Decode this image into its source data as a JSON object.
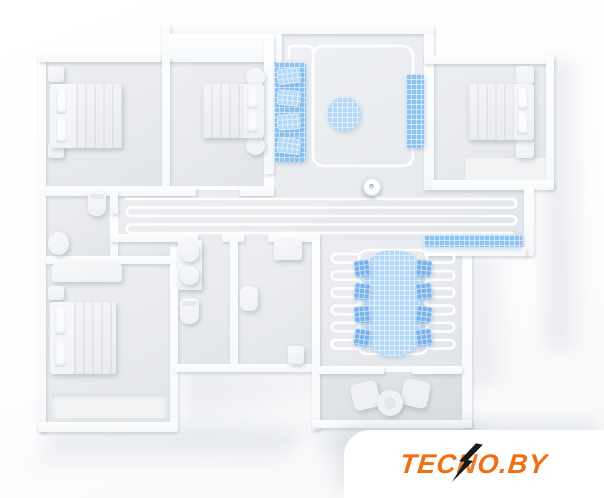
{
  "watermark": {
    "brand_pre": "TEC",
    "brand_bolt_letter": "N",
    "brand_post": "O.BY",
    "brand_full": "TECNO.BY",
    "text_color": "#ef6f12",
    "bolt_color": "#1a1a1a",
    "card_color": "#ffffff"
  },
  "palette": {
    "background": "#ffffff",
    "floor": "#e8eaed",
    "floor_balcony": "#dfe2e6",
    "wall": "#fcfdfe",
    "clean_path": "#ffffff",
    "highlight_blue": "#8ec4f2",
    "rug_blue": "#b3d8f8",
    "furniture_blue": "#77b2ec",
    "shadow": "#c6cdd5"
  },
  "scene": {
    "description": "3D top-down floor plan of an apartment; a robot vacuum's white cleaning paths snake through the rooms and cleaned carpets/furniture zones are highlighted in blue",
    "rooms": [
      "bedroom-top-left",
      "bedroom-top-middle",
      "living-room",
      "bedroom-top-right",
      "hallway",
      "kitchen",
      "dining-room",
      "bathroom-left",
      "bathroom-middle",
      "shower-room",
      "bedroom-bottom-left",
      "balcony"
    ],
    "highlighted_items": [
      "sofa",
      "tv-bench",
      "round-rug",
      "kitchen-mat",
      "dining-table",
      "dining-chairs"
    ],
    "robot": "robot-vacuum"
  }
}
